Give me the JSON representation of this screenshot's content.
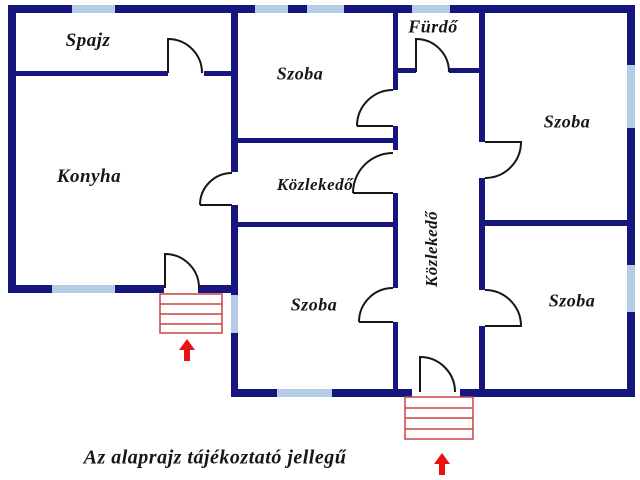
{
  "floorplan": {
    "rooms": [
      {
        "id": "spajz",
        "label": "Spajz"
      },
      {
        "id": "szoba-top-middle",
        "label": "Szoba"
      },
      {
        "id": "furdo",
        "label": "Fürdő"
      },
      {
        "id": "szoba-right-top",
        "label": "Szoba"
      },
      {
        "id": "konyha",
        "label": "Konyha"
      },
      {
        "id": "kozlekedo-middle",
        "label": "Közlekedő"
      },
      {
        "id": "kozlekedo-vertical",
        "label": "Közlekedő"
      },
      {
        "id": "szoba-bottom-middle",
        "label": "Szoba"
      },
      {
        "id": "szoba-right-bottom",
        "label": "Szoba"
      }
    ],
    "disclaimer": "Az alaprajz tájékoztató jellegű",
    "colors": {
      "wall": "#16167e",
      "window": "#b4cce6",
      "stairs": "#cb4242",
      "arrow": "#e91212",
      "ink": "#161616"
    }
  }
}
